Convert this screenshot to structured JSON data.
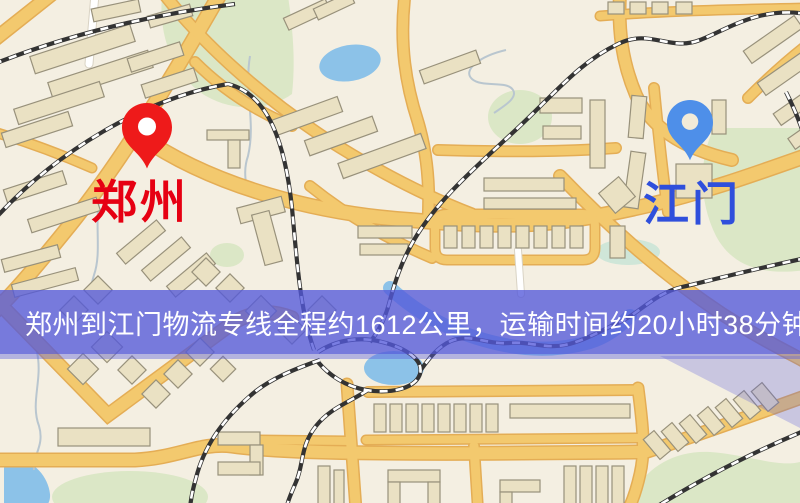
{
  "banner": {
    "text": "郑州到江门物流专线全程约1612公里，运输时间约20小时38分钟.",
    "text_color": "#ffffff"
  },
  "map": {
    "origin": {
      "name": "郑州",
      "label_color": "#e60012",
      "pin_color": "#ee1a1a"
    },
    "destination": {
      "name": "江门",
      "label_color": "#2f4fdc",
      "pin_color": "#4e8fe9"
    },
    "colors": {
      "background": "#f4efe2",
      "road": "#f3c96e",
      "road_casing": "#e4ad55",
      "minor_road": "#ffffff",
      "minor_road_casing": "#d9d3c4",
      "building": "#eae1c3",
      "building_outline": "#98917b",
      "park": "#dbe7c6",
      "park_teal": "#cfe6d8",
      "water": "#8cc2e8",
      "stream": "#b9c6cf",
      "railway": "#333333",
      "railway_dash": "#ffffff",
      "banner_bg": "rgba(83,88,218,0.78)",
      "tint": "rgba(90,95,220,0.42)",
      "tint_light": "rgba(90,95,220,0.28)"
    }
  }
}
